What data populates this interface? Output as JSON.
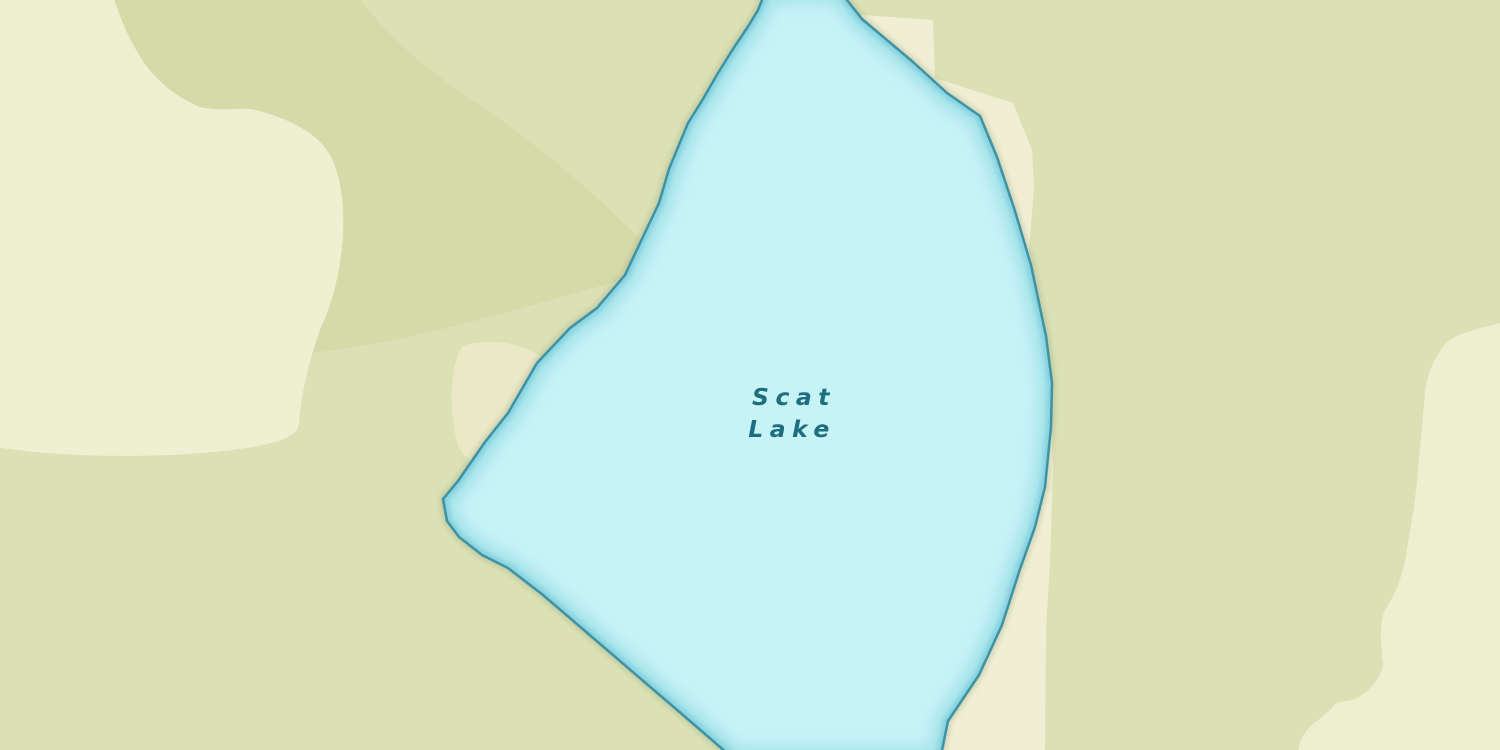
{
  "map": {
    "label": {
      "line1": "Scat",
      "line2": "Lake"
    },
    "label_style": {
      "color": "#1d6e7e",
      "font_size_px": 23.5,
      "letter_spacing_px": 6.5,
      "style": "italic"
    },
    "colors": {
      "land": "#dbe1b4",
      "grove": "#d4dba8",
      "clearing_west": "#efefd2",
      "sand_patch": "#ebe8c6",
      "shore_east": "#f1efd3",
      "clearing_southeast": "#eeefd1",
      "water_fill": "#c7f2f6",
      "water_inner_band": "#a9e5ec",
      "water_band_edge": "#86d2de",
      "water_outline": "#3d93a4",
      "label_text": "#1d6e7e"
    },
    "geometry": {
      "lake": "M 766,-10 L 758,10 L 749,25 L 733,49 L 718,73 L 703,99 L 688,123 L 669,169 L 659,203 L 641,241 L 625,275 L 597,308 L 570,328 L 537,363 L 508,413 L 485,442 L 458,481 L 443,499 L 447,521 L 459,537 L 482,555 L 508,568 L 543,595 L 613,655 L 683,715 L 735,760 L 940,760 L 948,721 L 979,675 L 1002,625 L 1020,569 L 1035,527 L 1045,487 L 1051,427 L 1052,383 L 1046,336 L 1031,265 L 1015,211 L 997,157 L 980,116 L 947,93 L 913,62 L 862,19 L 839,-10 Z",
      "clearing_west": "M -5,-5 L 113,-5 C 122,25 132,45 145,64 C 160,84 178,98 200,107 C 225,113 243,106 260,111 C 300,123 321,137 332,159 C 342,181 344,207 343,234 C 341,266 334,300 321,327 C 312,352 301,390 299,424 C 297,441 260,447 215,452 C 160,457 70,459 -5,447 Z",
      "grove": "M 112,-5 L 356,-5 C 395,45 440,80 480,105 C 530,140 580,180 615,215 C 632,230 652,250 664,268 C 580,292 500,315 430,332 C 380,344 320,353 272,357 C 290,352 310,350 321,327 C 334,300 342,266 343,234 C 343,207 342,181 332,159 C 321,137 300,123 260,111 C 240,105 225,112 200,107 C 178,98 160,84 145,64 C 132,45 122,25 113,-5 Z",
      "sand_patch": "M 462,346 C 488,338 520,342 540,356 C 560,371 566,396 560,421 C 552,449 530,463 505,466 C 479,469 461,459 457,441 C 450,415 448,372 462,346 Z",
      "shore_east": "M 848,14 L 933,20 L 935,78 L 1013,103 L 1032,150 L 1034,188 L 1029,250 L 1046,330 L 1051,400 L 1053,470 L 1050,560 L 1046,630 L 1045,760 L 888,760 L 910,715 L 952,648 L 992,578 L 1012,498 L 1021,400 L 1011,300 L 991,220 L 955,140 L 918,88 L 873,48 Z",
      "clearing_southeast": "M 1505,322 C 1470,330 1450,336 1442,348 C 1428,368 1425,385 1424,405 C 1421,440 1420,450 1418,470 C 1415,505 1411,525 1406,555 C 1401,585 1391,600 1384,612 C 1379,625 1381,650 1383,663 C 1383,672 1376,685 1361,696 C 1346,704 1341,700 1336,703 C 1331,710 1321,718 1313,724 C 1304,732 1299,740 1297,760 L 1505,760 Z"
    }
  }
}
